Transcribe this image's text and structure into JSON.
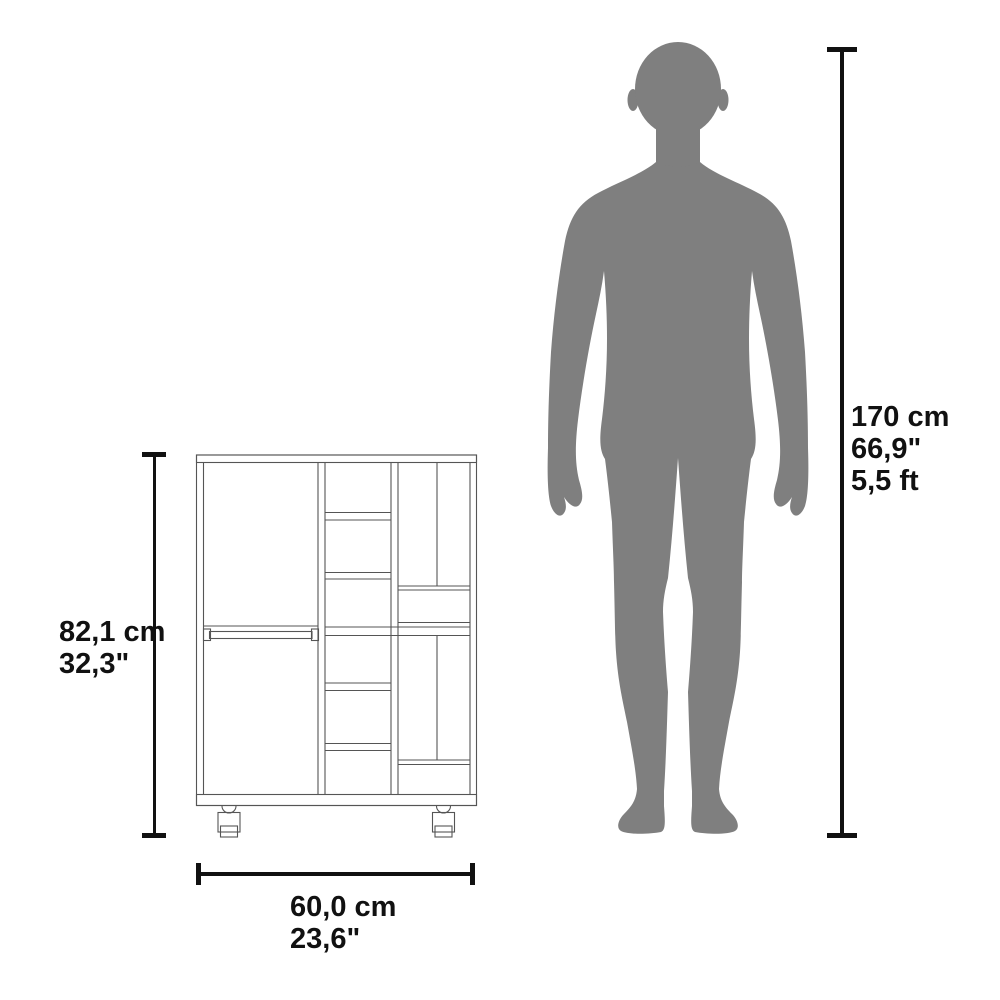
{
  "cabinet": {
    "height_cm": "82,1 cm",
    "height_in": "32,3\"",
    "width_cm": "60,0 cm",
    "width_in": "23,6\""
  },
  "person": {
    "height_cm": "170 cm",
    "height_in": "66,9\"",
    "height_ft": "5,5 ft"
  },
  "colors": {
    "background": "#ffffff",
    "silhouette": "#7f7f7f",
    "furniture_line": "#555555",
    "dimension": "#111111"
  }
}
